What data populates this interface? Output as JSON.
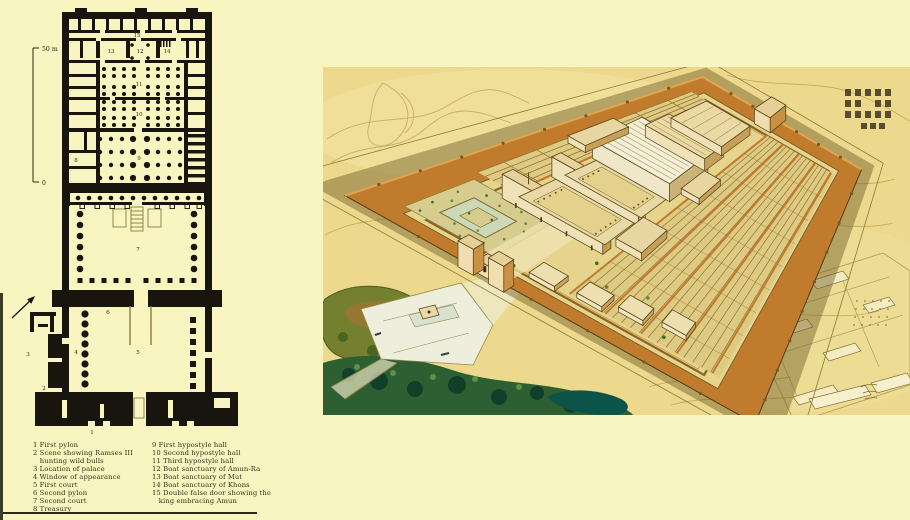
{
  "page": {
    "background": "#f8f5c1",
    "colors": {
      "plan_ink": "#17150d",
      "sand": "#ecd98e",
      "enclosure_wall_orange": "#c07c2c",
      "vegetation_dark_green": "#2e5f33",
      "pond_teal": "#0c5349",
      "quay_pale": "#edefdc"
    }
  },
  "plan": {
    "scale_top_label": "50 m",
    "scale_bottom_label": "0",
    "labels": {
      "n1": "1",
      "n2": "2",
      "n3": "3",
      "n4": "4",
      "n5": "5",
      "n6": "6",
      "n7": "7",
      "n8": "8",
      "n9": "9",
      "n10": "10",
      "n11": "11",
      "n12": "12",
      "n13": "13",
      "n14": "14",
      "n15": "15"
    }
  },
  "legend": {
    "left": [
      "1 First pylon",
      "2 Scene showing Ramses III",
      "   hunting wild bulls",
      "3 Location of palace",
      "4 Window of appearance",
      "5 First court",
      "6 Second pylon",
      "7 Second court",
      "8 Treasury"
    ],
    "right": [
      "9 First hypostyle hall",
      "10 Second hypostyle hall",
      "11 Third hypostyle hall",
      "12 Boat sanctuary of Amun-Ra",
      "13 Boat sanctuary of Mut",
      "14 Boat sanctuary of Khons",
      "15 Double false door showing the",
      "   king embracing Amun"
    ]
  }
}
